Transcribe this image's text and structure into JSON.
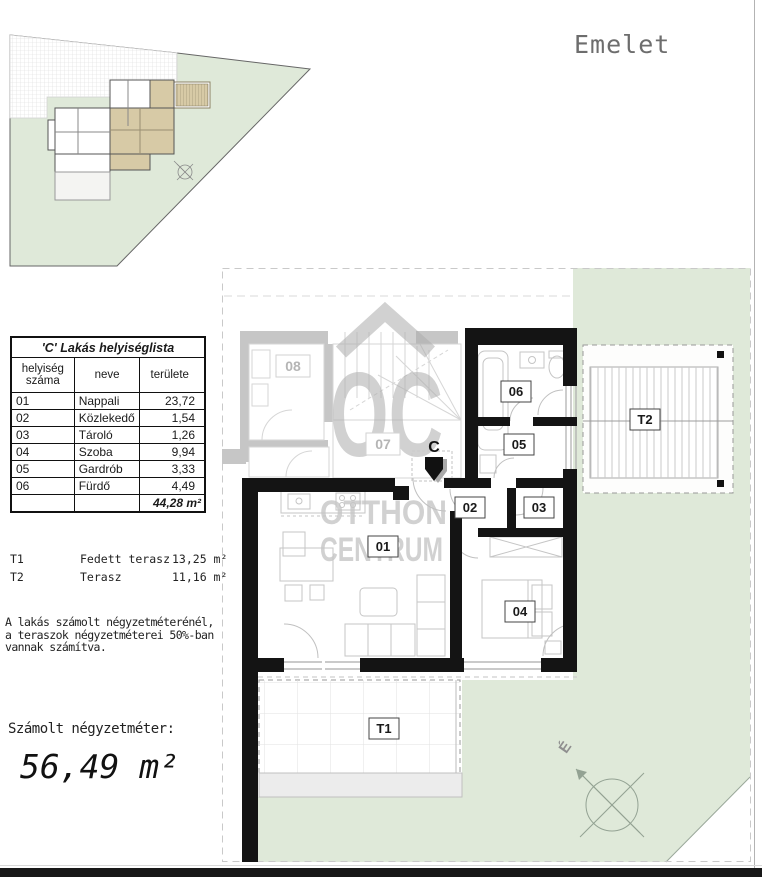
{
  "floor_label": "Emelet",
  "room_table": {
    "title": "'C' Lakás helyiséglista",
    "col_room_no": "helyiség száma",
    "col_name": "neve",
    "col_area": "területe",
    "rows": [
      {
        "num": "01",
        "name": "Nappali",
        "area": "23,72"
      },
      {
        "num": "02",
        "name": "Közlekedő",
        "area": "1,54"
      },
      {
        "num": "03",
        "name": "Tároló",
        "area": "1,26"
      },
      {
        "num": "04",
        "name": "Szoba",
        "area": "9,94"
      },
      {
        "num": "05",
        "name": "Gardrób",
        "area": "3,33"
      },
      {
        "num": "06",
        "name": "Fürdő",
        "area": "4,49"
      }
    ],
    "total_area": "44,28 m²"
  },
  "terrace_list": [
    {
      "code": "T1",
      "name": "Fedett terasz",
      "area": "13,25 m²"
    },
    {
      "code": "T2",
      "name": "Terasz",
      "area": "11,16 m²"
    }
  ],
  "note_lines": [
    "A lakás számolt négyzetméterénél,",
    "a teraszok négyzetméterei 50%-ban",
    "vannak számítva."
  ],
  "calculated_area": {
    "label": "Számolt négyzetméter:",
    "value": "56,49 m²"
  },
  "plan": {
    "unit_marker": "C",
    "rooms": {
      "r01": "01",
      "r02": "02",
      "r03": "03",
      "r04": "04",
      "r05": "05",
      "r06": "06"
    },
    "terraces": {
      "t1": "T1",
      "t2": "T2"
    },
    "neighbors": {
      "r07": "07",
      "r08": "08"
    },
    "compass_north": "É"
  },
  "watermark": {
    "logo": "OC",
    "line1": "OTTHON",
    "line2": "CENTRUM"
  },
  "colors": {
    "lot_green": "#dfe9d9",
    "terrace_tan": "#d7caa6",
    "wall_black": "#141414",
    "watermark_gray": "#adadad"
  }
}
